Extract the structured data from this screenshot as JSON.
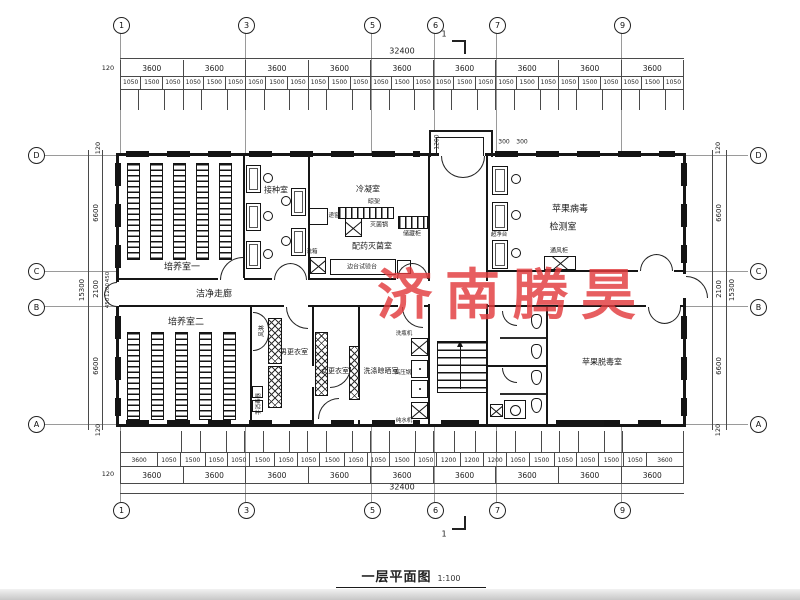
{
  "watermark": {
    "text": "济南腾昊",
    "color": "#e23b3e"
  },
  "title": {
    "name": "一层平面图",
    "scale": "1:100"
  },
  "section_mark": "1",
  "grid": {
    "top": [
      "1",
      "3",
      "5",
      "6",
      "7",
      "9"
    ],
    "bottom": [
      "1",
      "3",
      "5",
      "6",
      "7",
      "9"
    ],
    "left": [
      "D",
      "C",
      "B",
      "A"
    ],
    "right": [
      "D",
      "C",
      "B",
      "A"
    ]
  },
  "dims": {
    "total": "32400",
    "wall": "120",
    "bays": [
      "3600",
      "3600",
      "3600",
      "3600",
      "3600",
      "3600",
      "3600",
      "3600",
      "3600"
    ],
    "top_subs": [
      "1050",
      "1500",
      "1050",
      "1050",
      "1500",
      "1050",
      "1050",
      "1500",
      "1050",
      "1050",
      "1500",
      "1050",
      "1050",
      "1500",
      "1050",
      "1050",
      "1500",
      "1050",
      "1050",
      "1500",
      "1050",
      "1050",
      "1500",
      "1050",
      "1050",
      "1500",
      "1050"
    ],
    "bottom_subs": [
      "3600",
      "1050",
      "1500",
      "1050",
      "1050",
      "1500",
      "1050",
      "1050",
      "1500",
      "1050",
      "1050",
      "1500",
      "1050",
      "1200",
      "1200",
      "1200",
      "1050",
      "1500",
      "1050",
      "1050",
      "1500",
      "1050",
      "3600"
    ],
    "side": {
      "total": "15300",
      "upper": "6600",
      "lower": "6600",
      "mid": "2100",
      "mid_a": "450",
      "mid_b": "1200",
      "mid_c": "450",
      "wall": "120"
    },
    "porch": {
      "depth": "1200",
      "a": "300",
      "b": "300"
    }
  },
  "rooms": {
    "culture1": "培养室一",
    "inoculation": "接种室",
    "condensation": "冷凝室",
    "prep": "配药灭菌室",
    "virus_line1": "苹果病毒",
    "virus_line2": "检测室",
    "corridor": "洁净走廊",
    "culture2": "培养室二",
    "men": "男更衣室",
    "women": "女更衣室",
    "washing": "洗涤晾晒室",
    "detox": "苹果脱毒室"
  },
  "equipment": {
    "pass_window": "递窗",
    "wash_box": "洗箱",
    "rack": "晾架",
    "sterilizer": "灭菌锅",
    "cabinet": "储藏柜",
    "side_bench": "边台试验台",
    "clean_bench": "超净台",
    "fume_hood": "通风柜",
    "air_shower": "风淋",
    "hand_sanitizer": "手消毒器",
    "bottle_washer": "洗瓶机",
    "autoclave": "高压锅",
    "water_machine": "纯水机"
  }
}
